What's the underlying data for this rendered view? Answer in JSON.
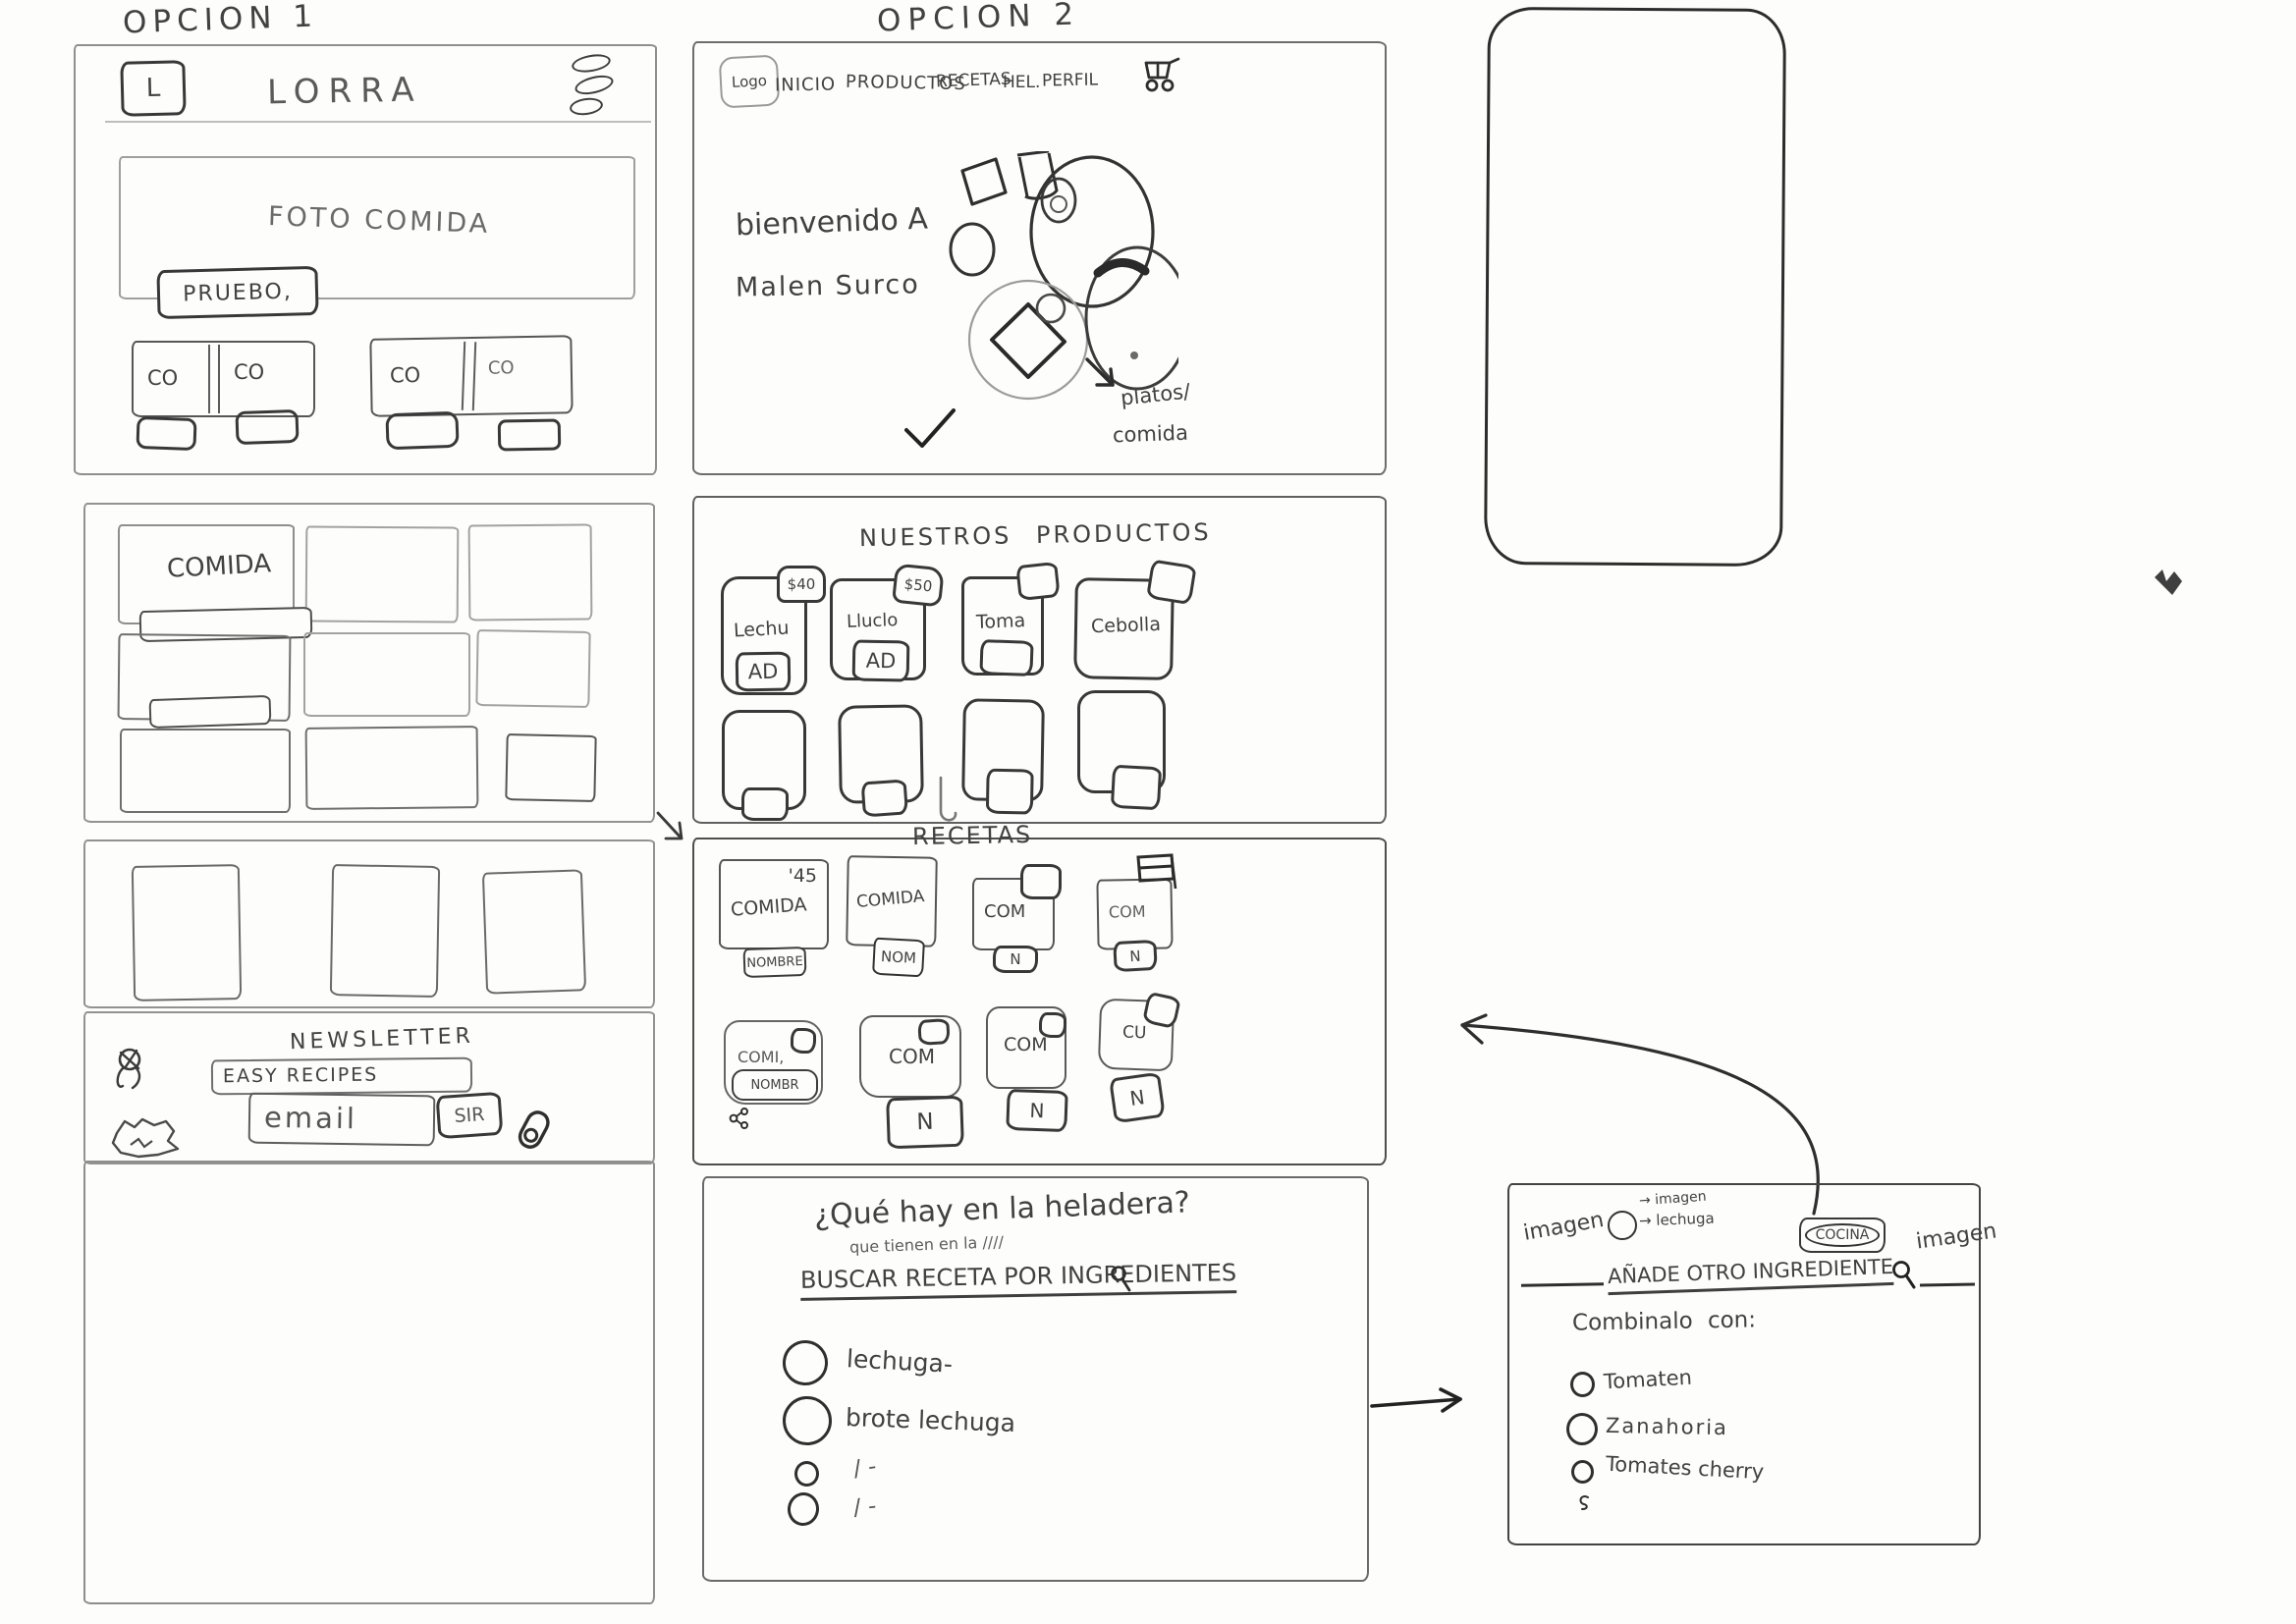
{
  "option1": {
    "title": "OPCION 1",
    "header": {
      "logo": "L",
      "brand": "LORRA"
    },
    "hero": {
      "label": "FOTO COMIDA",
      "button": "PRUEBO,"
    },
    "category_cards": [
      "CO",
      "CO",
      "CO",
      "CO"
    ],
    "gallery_label": "COMIDA",
    "newsletter": {
      "title": "NEWSLETTER",
      "recipes_field": "EASY RECIPES",
      "email_field": "email",
      "submit": "SIR"
    }
  },
  "option2": {
    "title": "OPCION 2",
    "nav": {
      "logo": "Logo",
      "items": [
        "INICIO",
        "PRODUCTOS",
        "RECETAS",
        "HEL.",
        "PERFIL"
      ]
    },
    "hero": {
      "welcome_1": "bienvenido A",
      "welcome_2": "Malen Surco",
      "note_1": "platos/",
      "note_2": "comida"
    },
    "products": {
      "title": "NUESTROS PRODUCTOS",
      "items": [
        {
          "name": "Lechu",
          "badge": "$40",
          "button": "AD"
        },
        {
          "name": "Lluclo",
          "badge": "$50",
          "button": "AD"
        },
        {
          "name": "Toma",
          "badge": "",
          "button": ""
        },
        {
          "name": "Cebolla",
          "badge": "",
          "button": ""
        }
      ]
    },
    "recipes": {
      "title": "RECETAS",
      "row1": [
        {
          "name": "COMIDA",
          "badge": "'45",
          "button": "NOMBRE"
        },
        {
          "name": "COMIDA",
          "badge": "",
          "button": "NOM"
        },
        {
          "name": "COM",
          "badge": "",
          "button": "N"
        },
        {
          "name": "COM",
          "badge": "",
          "button": "N"
        }
      ],
      "row2": [
        {
          "name": "COMI,",
          "inner": "NOMBR",
          "button": ""
        },
        {
          "name": "COM",
          "inner": "",
          "button": "N"
        },
        {
          "name": "COM",
          "inner": "",
          "button": "N"
        },
        {
          "name": "CU",
          "inner": "",
          "button": "N"
        }
      ]
    },
    "fridge": {
      "title": "¿Qué hay en la heladera?",
      "subtitle": "que tienen en la ////",
      "search_label": "BUSCAR RECETA POR INGREDIENTES",
      "options": [
        "lechuga-",
        "brote lechuga",
        "/ -",
        "/ -"
      ]
    }
  },
  "popup": {
    "left_label": "imagen",
    "right_label": "imagen",
    "note_top": "→ imagen",
    "note_bottom": "→ lechuga",
    "action": "COCINA",
    "title": "AÑADE OTRO INGREDIENTE",
    "combine_label": "Combinalo con:",
    "options": [
      "Tomaten",
      "Zanahoria",
      "Tomates cherry"
    ]
  }
}
